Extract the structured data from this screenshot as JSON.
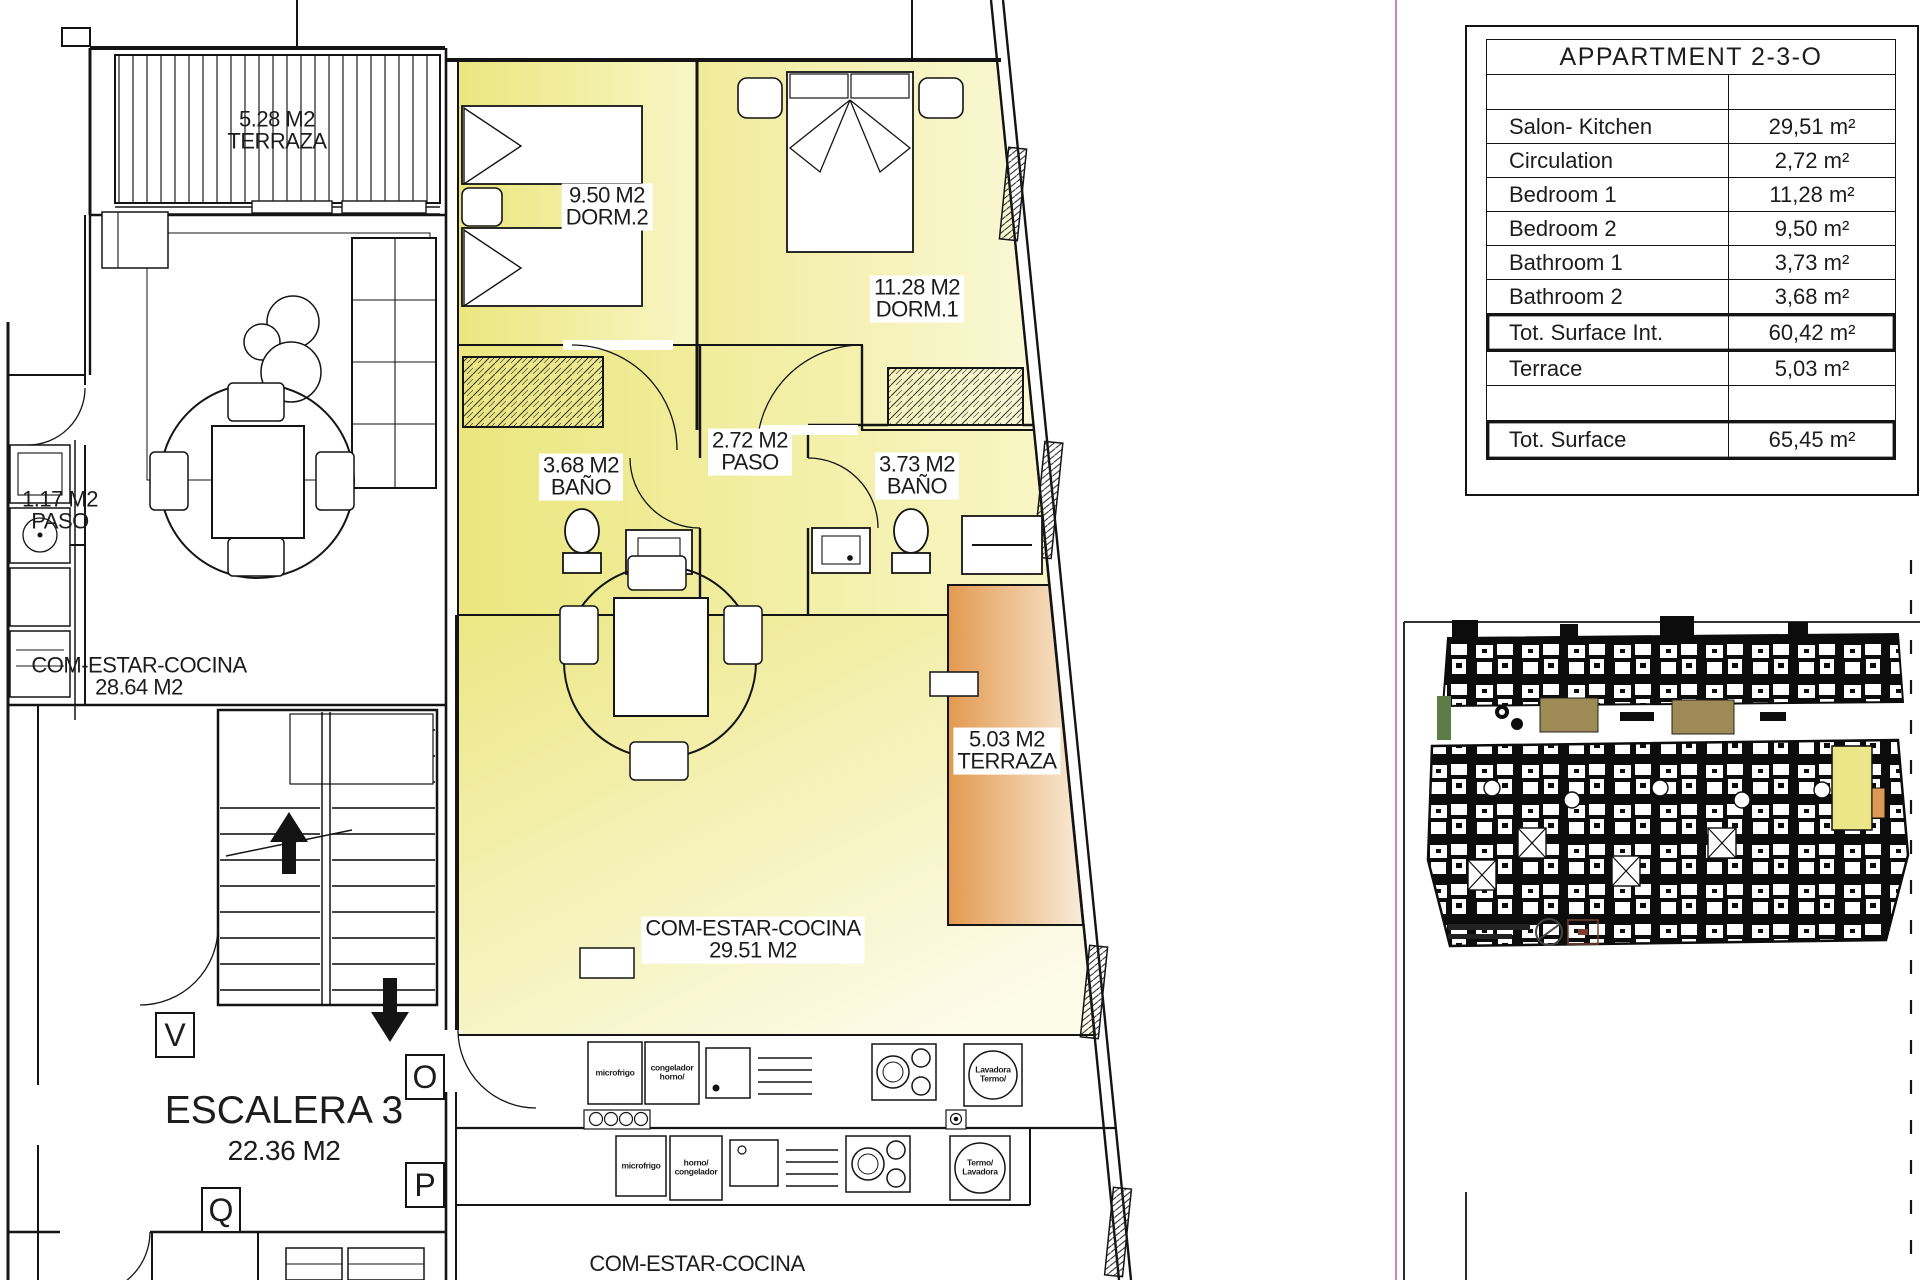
{
  "colors": {
    "room_yellow_dark": "#ece783",
    "room_yellow_light": "#fbf9d8",
    "terrace_orange_dark": "#e2994f",
    "terrace_orange_light": "#f9ecd9",
    "wall_black": "#141414",
    "frame_magenta": "#c47ab8",
    "thumb_highlight_yellow": "#ece688",
    "thumb_highlight_orange": "#dd9a55"
  },
  "table": {
    "title": "APPARTMENT 2-3-O",
    "rows": [
      {
        "label": "",
        "value": ""
      },
      {
        "label": "Salon- Kitchen",
        "value": "29,51 m²"
      },
      {
        "label": "Circulation",
        "value": "2,72 m²"
      },
      {
        "label": "Bedroom 1",
        "value": "11,28 m²"
      },
      {
        "label": "Bedroom 2",
        "value": "9,50 m²"
      },
      {
        "label": "Bathroom 1",
        "value": "3,73 m²"
      },
      {
        "label": "Bathroom 2",
        "value": "3,68 m²"
      },
      {
        "label": "Tot. Surface Int.",
        "value": "60,42 m²"
      },
      {
        "label": "Terrace",
        "value": "5,03 m²"
      },
      {
        "label": "",
        "value": ""
      },
      {
        "label": "Tot. Surface",
        "value": "65,45 m²"
      }
    ]
  },
  "plan": {
    "labels": {
      "terrace_top": {
        "l1": "5.28 M2",
        "l2": "TERRAZA"
      },
      "dorm2": {
        "l1": "9.50 M2",
        "l2": "DORM.2"
      },
      "dorm1": {
        "l1": "11.28 M2",
        "l2": "DORM.1"
      },
      "paso": {
        "l1": "2.72 M2",
        "l2": "PASO"
      },
      "bano1": {
        "l1": "3.68 M2",
        "l2": "BAÑO"
      },
      "bano2": {
        "l1": "3.73 M2",
        "l2": "BAÑO"
      },
      "paso_small": {
        "l1": "1.17 M2",
        "l2": "PASO"
      },
      "living_left": {
        "l1": "COM-ESTAR-COCINA",
        "l2": "28.64 M2"
      },
      "stairs": {
        "l1": "ESCALERA 3",
        "l2": "22.36 M2"
      },
      "terrace_right": {
        "l1": "5.03 M2",
        "l2": "TERRAZA"
      },
      "living_main": {
        "l1": "COM-ESTAR-COCINA",
        "l2": "29.51 M2"
      },
      "living_bottom": {
        "l1": "COM-ESTAR-COCINA"
      }
    },
    "markers": {
      "v": "V",
      "o": "O",
      "p": "P",
      "q": "Q"
    },
    "appliances": {
      "fridge_top": "microfrigo",
      "oven_top": "congelador horno/",
      "washer_top": "Lavadora Termo/",
      "fridge_bottom": "microfrigo",
      "oven_bottom": "horno/ congelador",
      "washer_bottom": "Termo/ Lavadora"
    }
  }
}
